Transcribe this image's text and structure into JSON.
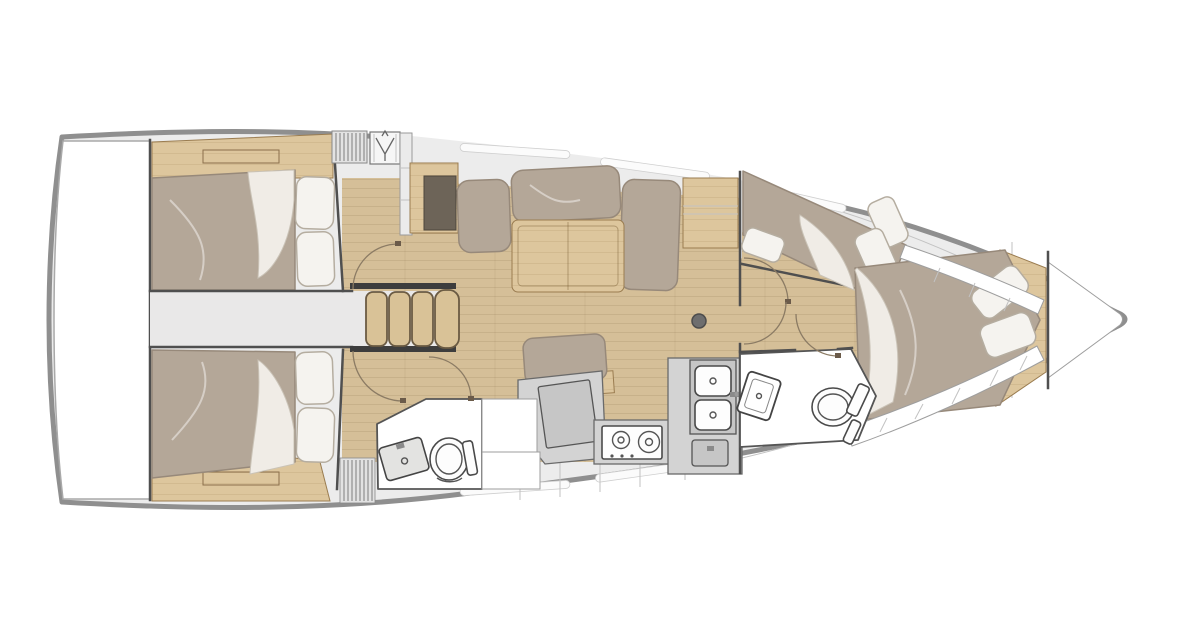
{
  "title": "Sailboat interior floor plan (top view)",
  "diagram_type": "yacht-floorplan",
  "palette": {
    "hull_stroke": "#8f8f8f",
    "wall": "#4f4f4f",
    "deck": "#ececec",
    "corridor": "#e9e8e8",
    "wood_floor": "#d5bf98",
    "wood_cabinet": "#ddc69d",
    "wood_dark_inset": "#6d6458",
    "wood_step": "#d9c297",
    "mattress": "#b4a798",
    "mattress_stroke": "#97897a",
    "pillow": "#f5f3ef",
    "pillow_stroke": "#b5ada0",
    "duvet": "#f0ece6",
    "duvet_stroke": "#cac3b7",
    "white": "#ffffff",
    "counter": "#d3d3d3",
    "counter_dark": "#c6c6c6",
    "fixture": "#fdfdfd",
    "line_light": "#c2c2c2",
    "door_arc": "#8b7b64",
    "post": "#6e6e6e"
  },
  "rooms": {
    "swim_platform": "Swim platform (transom)",
    "aft_cabin_port": "Aft double cabin (top)",
    "aft_cabin_starboard": "Aft double cabin (bottom)",
    "passage": "Passage between aft cabins",
    "companionway": "Companionway steps",
    "salon": "Salon with U-settee and table",
    "nav_area": "Chart / work surface",
    "galley": "Galley with stove and double sink",
    "aft_head": "Aft head with toilet and sink",
    "forward_head": "Forward head with toilet and sink",
    "forward_cabin_port": "Forward cabin with angled berth",
    "forward_cabin": "Forward cabin with island berth",
    "bow_locker": "Bow anchor locker",
    "mast": "Mast post"
  }
}
